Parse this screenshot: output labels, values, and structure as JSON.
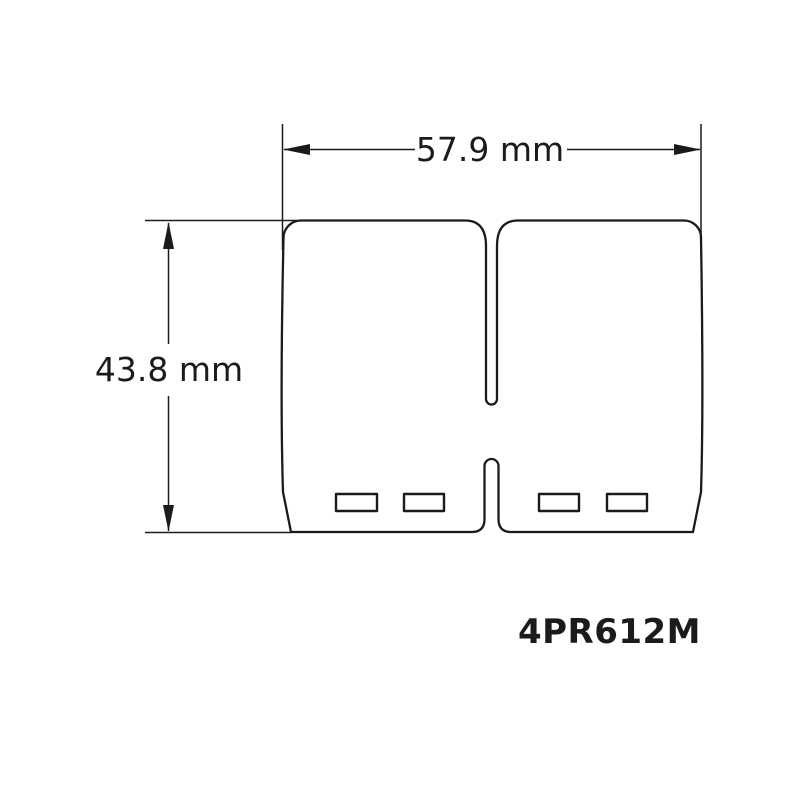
{
  "colors": {
    "line": "#1b1b1b",
    "background": "#ffffff"
  },
  "drawing": {
    "width_dimension_label": "57.9 mm",
    "height_dimension_label": "43.8 mm",
    "part_number": "4PR612M"
  }
}
